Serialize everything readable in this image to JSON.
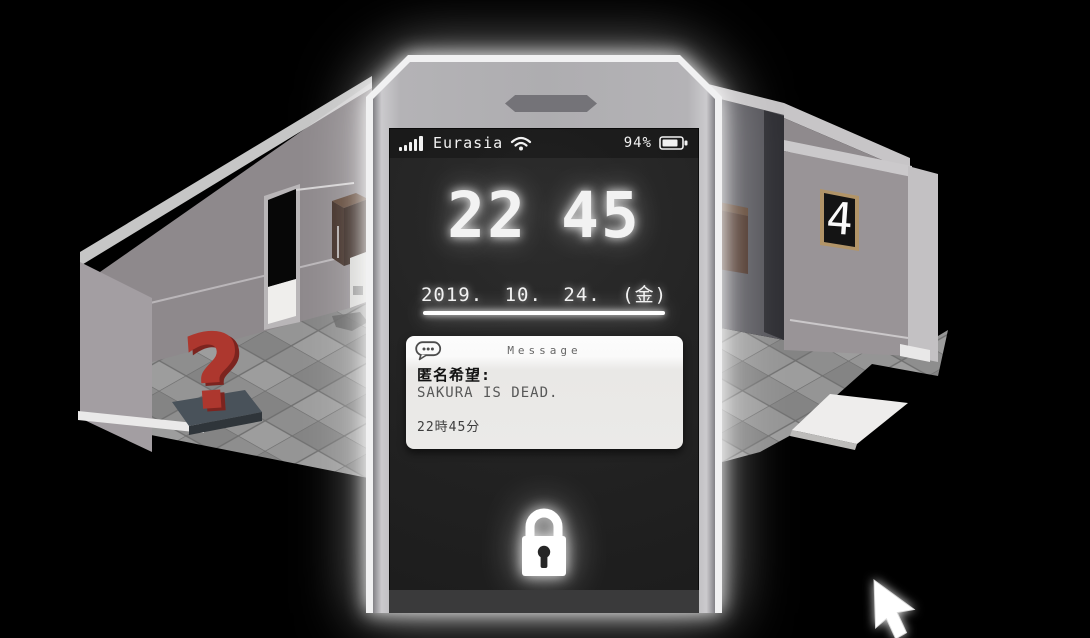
{
  "scene": {
    "room_sign": "4",
    "statue_glyph": "?"
  },
  "phone": {
    "status_bar": {
      "carrier": "Eurasia",
      "battery_percent": "94%"
    },
    "clock": {
      "hours": "22",
      "minutes": "45"
    },
    "date": "2019. 10. 24. (金)",
    "notification": {
      "app_name": "Message",
      "sender": "匿名希望:",
      "message": "SAKURA IS DEAD.",
      "time": "22時45分"
    }
  },
  "colors": {
    "statue_red": "#ad372e",
    "sign_frame_tan": "#b19468",
    "glow_white": "#ffffff"
  }
}
